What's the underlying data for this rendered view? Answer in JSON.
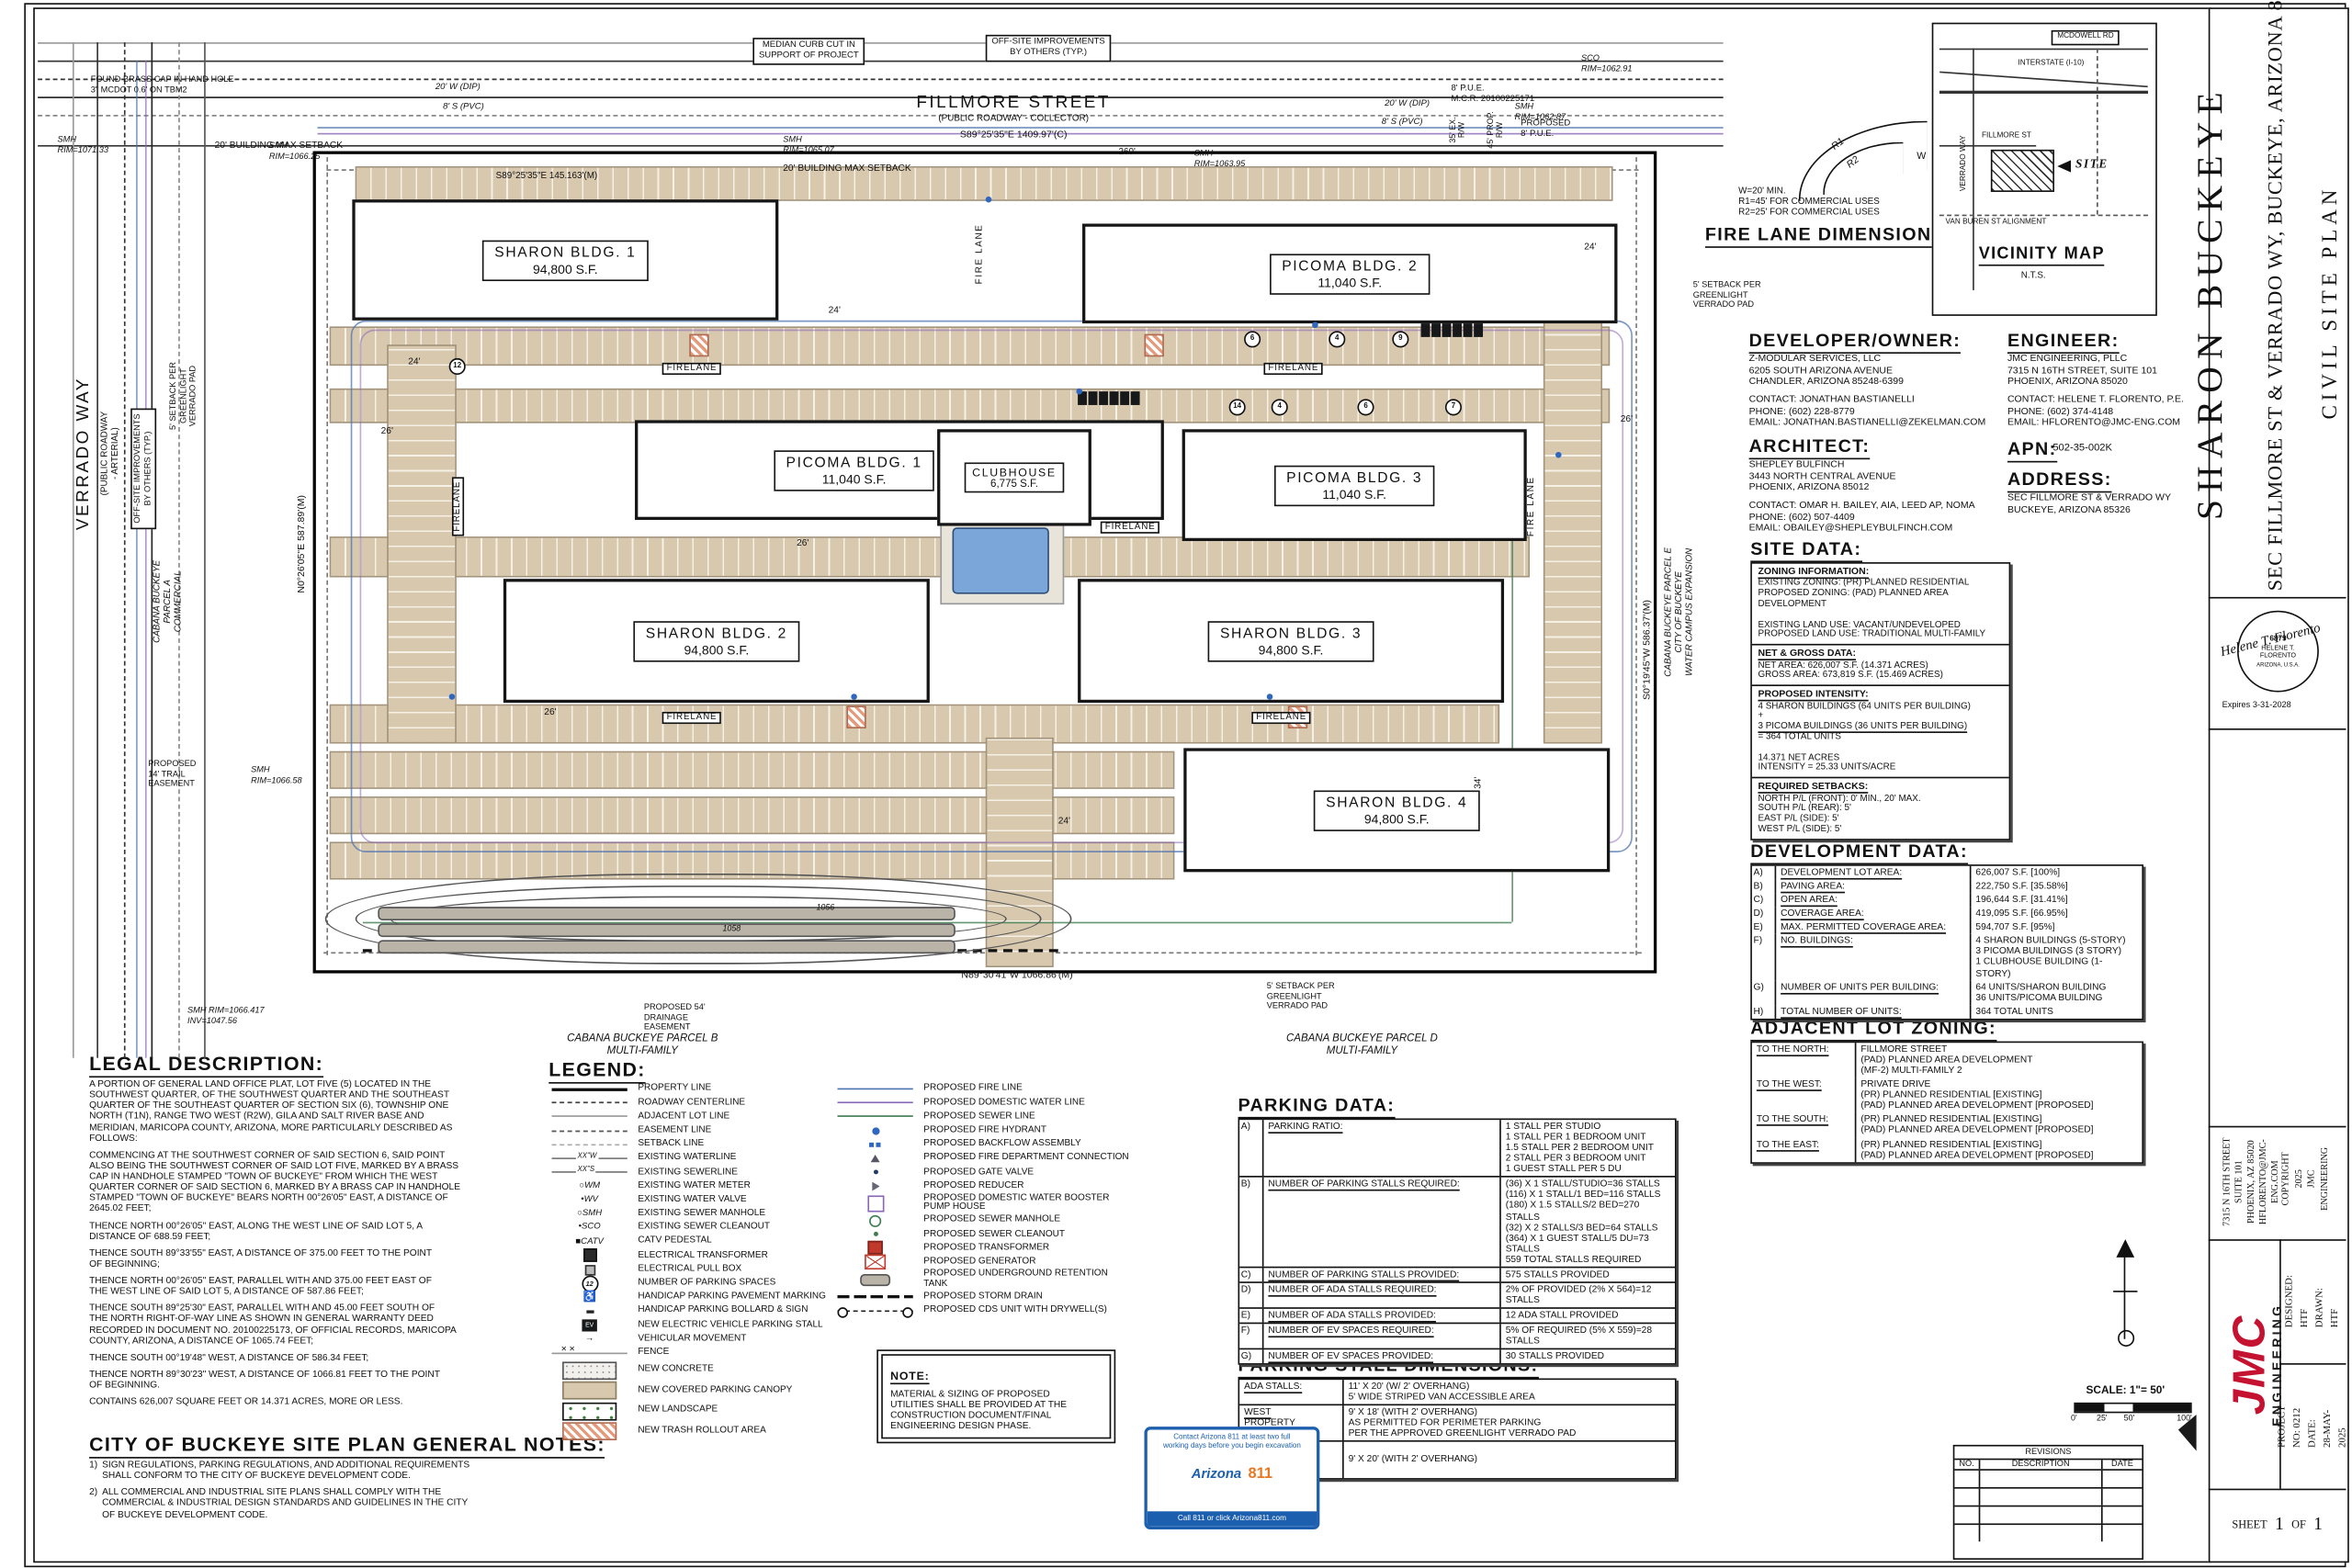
{
  "title_block": {
    "project_title": "SHARON BUCKEYE",
    "project_subtitle": "SEC FILLMORE ST & VERRADO WY, BUCKEYE, ARIZONA 85326",
    "sheet_name": "CIVIL SITE PLAN",
    "seal": {
      "number": "6879",
      "name1": "HELENE T.",
      "name2": "FLORENTO",
      "state": "ARIZONA, U.S.A.",
      "signature": "Helene T. Florento",
      "expires": "Expires 3-31-2028"
    },
    "firm_address": "7315 N 16TH STREET\nSUITE 101\nPHOENIX, AZ 85020\nHFLORENTO@JMC-ENG.COM",
    "copyright": "COPYRIGHT 2025\nJMC ENGINEERING",
    "logo_jmc": "JMC",
    "logo_engineering": "ENGINEERING",
    "designed": "DESIGNED:   HTF\nDRAWN:       HTF",
    "project": "PROJECT NO: 0212\nDATE:  28-MAY-2025",
    "sheet_label": "SHEET",
    "sheet_no": "1",
    "of_label": "OF",
    "sheet_total": "1"
  },
  "revisions": {
    "title": "REVISIONS",
    "col_no": "NO.",
    "col_desc": "DESCRIPTION",
    "col_date": "DATE"
  },
  "scale": {
    "label": "SCALE: 1\"= 50'",
    "t0": "0'",
    "t1": "25'",
    "t2": "50'",
    "t3": "100'"
  },
  "az811": {
    "top": "Contact Arizona 811 at least two full\nworking days before you begin excavation",
    "brand_a": "Arizona",
    "brand_b": "811",
    "bottom": "Call 811 or click Arizona811.com"
  },
  "vicinity": {
    "mcdowell": "MCDOWELL RD",
    "i10": "INTERSTATE (I-10)",
    "verrado": "VERRADO WAY",
    "fillmore": "FILLMORE ST",
    "site": "SITE",
    "vanburen": "VAN BUREN ST ALIGNMENT",
    "title": "VICINITY MAP",
    "nts": "N.T.S."
  },
  "fire_lane": {
    "heading": "FIRE LANE DIMENSIONS",
    "notes": "W=20' MIN.\nR1=45' FOR COMMERCIAL USES\nR2=25' FOR COMMERCIAL USES",
    "r1": "R1",
    "r2": "R2",
    "w": "W"
  },
  "contacts": {
    "developer": {
      "heading": "DEVELOPER/OWNER:",
      "addr": "Z-MODULAR SERVICES, LLC\n6205 SOUTH ARIZONA AVENUE\nCHANDLER, ARIZONA 85248-6399",
      "contact": "CONTACT: JONATHAN BASTIANELLI\nPHONE: (602) 228-8779\nEMAIL: JONATHAN.BASTIANELLI@ZEKELMAN.COM"
    },
    "architect": {
      "heading": "ARCHITECT:",
      "addr": "SHEPLEY BULFINCH\n3443 NORTH CENTRAL AVENUE\nPHOENIX, ARIZONA 85012",
      "contact": "CONTACT: OMAR H. BAILEY, AIA, LEED AP, NOMA\nPHONE: (602) 507-4409\nEMAIL: OBAILEY@SHEPLEYBULFINCH.COM"
    },
    "engineer": {
      "heading": "ENGINEER:",
      "addr": "JMC ENGINEERING, PLLC\n7315 N 16TH STREET, SUITE 101\nPHOENIX, ARIZONA 85020",
      "contact": "CONTACT: HELENE T. FLORENTO, P.E.\nPHONE: (602) 374-4148\nEMAIL: HFLORENTO@JMC-ENG.COM"
    },
    "apn_label": "APN:",
    "apn_value": "502-35-002K",
    "address_heading": "ADDRESS:",
    "address_lines": "SEC FILLMORE ST & VERRADO WY\nBUCKEYE, ARIZONA 85326"
  },
  "site_data": {
    "heading": "SITE DATA:",
    "zoning_h": "ZONING INFORMATION:",
    "zoning": "EXISTING ZONING: (PR) PLANNED RESIDENTIAL\nPROPOSED ZONING: (PAD) PLANNED AREA DEVELOPMENT\n\nEXISTING LAND USE: VACANT/UNDEVELOPED\nPROPOSED LAND USE: TRADITIONAL MULTI-FAMILY",
    "net_h": "NET & GROSS DATA:",
    "net": "NET AREA: 626,007 S.F. (14.371 ACRES)\nGROSS AREA: 673,819 S.F. (15.469 ACRES)",
    "intensity_h": "PROPOSED INTENSITY:",
    "intensity1": "4 SHARON BUILDINGS (64 UNITS PER BUILDING)\n+",
    "intensity2": "3 PICOMA BUILDINGS (36 UNITS PER BUILDING)",
    "intensity3": "= 364 TOTAL UNITS\n\n14.371 NET ACRES\nINTENSITY = 25.33 UNITS/ACRE",
    "setbacks_h": "REQUIRED SETBACKS:",
    "setbacks": "NORTH P/L (FRONT):  0' MIN., 20' MAX.\nSOUTH P/L (REAR):   5'\nEAST P/L (SIDE):      5'\nWEST P/L (SIDE):     5'"
  },
  "development_data": {
    "heading": "DEVELOPMENT DATA:",
    "rows": [
      {
        "k": "A)",
        "label": "DEVELOPMENT LOT AREA:",
        "value": "626,007 S.F. [100%]"
      },
      {
        "k": "B)",
        "label": "PAVING AREA:",
        "value": "222,750  S.F. [35.58%]"
      },
      {
        "k": "C)",
        "label": "OPEN AREA:",
        "value": "196,644 S.F. [31.41%]"
      },
      {
        "k": "D)",
        "label": "COVERAGE AREA:",
        "value": "419,095 S.F. [66.95%]"
      },
      {
        "k": "E)",
        "label": "MAX. PERMITTED COVERAGE AREA:",
        "value": "594,707 S.F. [95%]"
      },
      {
        "k": "F)",
        "label": "NO. BUILDINGS:",
        "value": "4 SHARON BUILDINGS (5-STORY)\n3 PICOMA BUILDINGS (3 STORY)\n1 CLUBHOUSE BUILDING (1-STORY)"
      },
      {
        "k": "G)",
        "label": "NUMBER OF UNITS PER BUILDING:",
        "value": "64 UNITS/SHARON BUILDING\n36 UNITS/PICOMA BUILDING"
      },
      {
        "k": "H)",
        "label": "TOTAL NUMBER OF UNITS:",
        "value": "364 TOTAL UNITS"
      }
    ]
  },
  "adjacent_zoning": {
    "heading": "ADJACENT LOT ZONING:",
    "rows": [
      {
        "label": "TO THE NORTH:",
        "value": "FILLMORE STREET\n(PAD) PLANNED AREA DEVELOPMENT\n(MF-2) MULTI-FAMILY 2"
      },
      {
        "label": "TO THE WEST:",
        "value": "PRIVATE DRIVE\n(PR) PLANNED RESIDENTIAL [EXISTING]\n(PAD) PLANNED AREA DEVELOPMENT [PROPOSED]"
      },
      {
        "label": "TO THE SOUTH:",
        "value": "(PR) PLANNED RESIDENTIAL [EXISTING]\n(PAD) PLANNED AREA DEVELOPMENT [PROPOSED]"
      },
      {
        "label": "TO THE EAST:",
        "value": "(PR) PLANNED RESIDENTIAL [EXISTING]\n(PAD) PLANNED AREA DEVELOPMENT [PROPOSED]"
      }
    ]
  },
  "parking_data": {
    "heading": "PARKING DATA:",
    "rows": [
      {
        "k": "A)",
        "label": "PARKING RATIO:",
        "value": "1 STALL PER STUDIO\n1 STALL PER 1 BEDROOM UNIT\n1.5 STALL PER 2 BEDROOM UNIT\n2 STALL PER 3 BEDROOM UNIT\n1 GUEST STALL PER 5 DU"
      },
      {
        "k": "B)",
        "label": "NUMBER OF PARKING STALLS REQUIRED:",
        "value": "(36) X 1 STALL/STUDIO=36 STALLS\n(116) X 1 STALL/1 BED=116 STALLS\n(180) X 1.5 STALLS/2 BED=270 STALLS\n(32) X 2 STALLS/3 BED=64 STALLS\n(364) X 1 GUEST STALL/5 DU=73 STALLS\n559 TOTAL STALLS REQUIRED"
      },
      {
        "k": "C)",
        "label": "NUMBER OF PARKING STALLS PROVIDED:",
        "value": "575 STALLS PROVIDED"
      },
      {
        "k": "D)",
        "label": "NUMBER OF ADA STALLS REQUIRED:",
        "value": "2% OF PROVIDED (2% X 564)=12 STALLS"
      },
      {
        "k": "E)",
        "label": "NUMBER OF ADA STALLS PROVIDED:",
        "value": "12 ADA STALL PROVIDED"
      },
      {
        "k": "F)",
        "label": "NUMBER OF EV SPACES REQUIRED:",
        "value": "5% OF REQUIRED (5% X 559)=28 STALLS"
      },
      {
        "k": "G)",
        "label": "NUMBER OF EV SPACES PROVIDED:",
        "value": "30 STALLS PROVIDED"
      }
    ]
  },
  "stall_dims": {
    "heading": "PARKING STALL DIMENSIONS:",
    "rows": [
      {
        "label": "ADA STALLS:",
        "value": "11' X 20' (W/ 2' OVERHANG)\n5' WIDE STRIPED VAN ACCESSIBLE AREA"
      },
      {
        "label": "WEST\nPROPERTY\nBOUNDARY:",
        "value": "9' X 18' (WITH 2' OVERHANG)\nAS PERMITTED FOR PERIMETER PARKING\nPER THE APPROVED GREENLIGHT VERRADO PAD"
      },
      {
        "label": "STANDARD\nPARKING\nREST OF SITE:",
        "value": "9' X 20' (WITH 2' OVERHANG)"
      }
    ]
  },
  "legal": {
    "heading": "LEGAL DESCRIPTION:",
    "paragraphs": [
      "A PORTION OF GENERAL LAND OFFICE PLAT, LOT FIVE (5) LOCATED IN THE\nSOUTHWEST QUARTER, OF THE SOUTHWEST QUARTER AND THE SOUTHEAST\nQUARTER OF THE SOUTHEAST QUARTER OF SECTION SIX (6), TOWNSHIP ONE\nNORTH (T1N), RANGE TWO WEST (R2W), GILA AND SALT RIVER BASE AND\nMERIDIAN, MARICOPA COUNTY, ARIZONA, MORE PARTICULARLY DESCRIBED AS\nFOLLOWS:",
      "COMMENCING AT THE SOUTHWEST CORNER OF SAID SECTION 6, SAID POINT\nALSO BEING THE SOUTHWEST CORNER OF SAID LOT FIVE, MARKED BY A BRASS\nCAP IN HANDHOLE STAMPED \"TOWN OF BUCKEYE\" FROM WHICH THE WEST\nQUARTER CORNER OF SAID SECTION 6, MARKED BY A BRASS CAP IN HANDHOLE\nSTAMPED \"TOWN OF BUCKEYE\" BEARS  NORTH 00°26'05\" EAST, A DISTANCE OF\n2645.02 FEET;",
      "THENCE NORTH 00°26'05\" EAST, ALONG THE WEST LINE OF SAID LOT 5, A\nDISTANCE OF 688.59 FEET;",
      "THENCE SOUTH 89°33'55\" EAST, A DISTANCE OF 375.00 FEET TO THE POINT\nOF BEGINNING;",
      "THENCE NORTH 00°26'05\" EAST, PARALLEL WITH AND 375.00 FEET EAST OF\nTHE WEST LINE OF SAID LOT 5, A DISTANCE OF 587.86 FEET;",
      "THENCE SOUTH 89°25'30\" EAST, PARALLEL WITH AND 45.00 FEET SOUTH OF\nTHE NORTH RIGHT-OF-WAY LINE AS SHOWN IN GENERAL WARRANTY DEED\nRECORDED IN DOCUMENT NO. 20100225173, OF OFFICIAL RECORDS, MARICOPA\nCOUNTY, ARIZONA, A DISTANCE OF 1065.74 FEET;",
      "THENCE SOUTH 00°19'48\" WEST, A DISTANCE OF 586.34 FEET;",
      "THENCE NORTH 89°30'23\" WEST, A DISTANCE OF 1066.81 FEET TO THE POINT\nOF BEGINNING.",
      "CONTAINS 626,007 SQUARE FEET OR 14.371 ACRES, MORE OR LESS."
    ]
  },
  "general_notes": {
    "heading": "CITY OF BUCKEYE SITE PLAN GENERAL NOTES:",
    "notes": [
      {
        "num": "1)",
        "text": "SIGN REGULATIONS, PARKING REGULATIONS, AND ADDITIONAL REQUIREMENTS\nSHALL CONFORM TO THE CITY OF BUCKEYE DEVELOPMENT CODE."
      },
      {
        "num": "2)",
        "text": "ALL COMMERCIAL AND INDUSTRIAL SITE PLANS SHALL COMPLY WITH THE\nCOMMERCIAL & INDUSTRIAL DESIGN STANDARDS AND GUIDELINES IN THE CITY\nOF BUCKEYE DEVELOPMENT CODE."
      }
    ]
  },
  "legend": {
    "heading": "LEGEND:",
    "left": [
      {
        "label": "PROPERTY LINE"
      },
      {
        "label": "ROADWAY CENTERLINE"
      },
      {
        "label": "ADJACENT LOT LINE"
      },
      {
        "label": "EASEMENT LINE"
      },
      {
        "label": "SETBACK LINE"
      },
      {
        "sym": "XX\"W",
        "label": "EXISTING WATERLINE"
      },
      {
        "sym": "XX\"S",
        "label": "EXISTING SEWERLINE"
      },
      {
        "sym": "○WM",
        "label": "EXISTING WATER METER"
      },
      {
        "sym": "•WV",
        "label": "EXISTING WATER VALVE"
      },
      {
        "sym": "○SMH",
        "label": "EXISTING SEWER MANHOLE"
      },
      {
        "sym": "•SCO",
        "label": "EXISTING SEWER CLEANOUT"
      },
      {
        "sym": "■CATV",
        "label": "CATV PEDESTAL"
      },
      {
        "label": "ELECTRICAL TRANSFORMER"
      },
      {
        "label": "ELECTRICAL PULL BOX"
      },
      {
        "sym": "12",
        "label": "NUMBER OF PARKING SPACES"
      },
      {
        "sym": "♿",
        "label": "HANDICAP PARKING PAVEMENT MARKING"
      },
      {
        "label": "HANDICAP PARKING BOLLARD & SIGN"
      },
      {
        "sym": "EV",
        "label": "NEW ELECTRIC VEHICLE PARKING STALL"
      },
      {
        "sym": "→",
        "label": "VEHICULAR MOVEMENT"
      },
      {
        "sym": "✕      ✕",
        "label": "FENCE"
      },
      {
        "label": "NEW CONCRETE"
      },
      {
        "label": "NEW COVERED PARKING CANOPY"
      },
      {
        "label": "NEW LANDSCAPE"
      },
      {
        "label": "NEW TRASH ROLLOUT AREA"
      }
    ],
    "right": [
      {
        "label": "PROPOSED FIRE LINE"
      },
      {
        "label": "PROPOSED DOMESTIC WATER LINE"
      },
      {
        "label": "PROPOSED SEWER LINE"
      },
      {
        "label": "PROPOSED FIRE HYDRANT"
      },
      {
        "label": "PROPOSED BACKFLOW ASSEMBLY"
      },
      {
        "label": "PROPOSED FIRE DEPARTMENT CONNECTION"
      },
      {
        "label": "PROPOSED GATE VALVE"
      },
      {
        "label": "PROPOSED REDUCER"
      },
      {
        "label": "PROPOSED DOMESTIC WATER BOOSTER\nPUMP HOUSE"
      },
      {
        "label": "PROPOSED SEWER MANHOLE"
      },
      {
        "label": "PROPOSED SEWER CLEANOUT"
      },
      {
        "label": "PROPOSED TRANSFORMER"
      },
      {
        "label": "PROPOSED GENERATOR"
      },
      {
        "label": "PROPOSED UNDERGROUND RETENTION\nTANK"
      },
      {
        "label": "PROPOSED STORM DRAIN"
      },
      {
        "label": "PROPOSED CDS UNIT WITH DRYWELL(S)"
      }
    ]
  },
  "note_box": {
    "heading": "NOTE:",
    "text": "MATERIAL & SIZING OF PROPOSED\nUTILITIES SHALL BE PROVIDED AT THE\nCONSTRUCTION DOCUMENT/FINAL\nENGINEERING DESIGN PHASE."
  },
  "plan": {
    "firelane": "FIRELANE",
    "firelane2": "FIRE LANE",
    "buildings": [
      {
        "name": "SHARON BLDG. 1",
        "sf": "94,800 S.F."
      },
      {
        "name": "PICOMA BLDG. 2",
        "sf": "11,040 S.F."
      },
      {
        "name": "PICOMA BLDG. 1",
        "sf": "11,040 S.F."
      },
      {
        "name": "CLUBHOUSE",
        "sf": "6,775 S.F."
      },
      {
        "name": "PICOMA BLDG. 3",
        "sf": "11,040 S.F."
      },
      {
        "name": "SHARON BLDG. 2",
        "sf": "94,800 S.F."
      },
      {
        "name": "SHARON BLDG. 3",
        "sf": "94,800 S.F."
      },
      {
        "name": "SHARON BLDG. 4",
        "sf": "94,800 S.F."
      }
    ],
    "labels": [
      {
        "t": "FOUND BRASS CAP IN HAND HOLE\n3\" MCDOT 0.6' ON TBM2"
      },
      {
        "t": "MEDIAN CURB CUT IN\nSUPPORT OF PROJECT"
      },
      {
        "t": "OFF-SITE IMPROVEMENTS\nBY OTHERS (TYP.)"
      },
      {
        "t": "FILLMORE STREET"
      },
      {
        "t": "(PUBLIC ROADWAY - COLLECTOR)"
      },
      {
        "t": "S89°25'35\"E  1409.97'(C)"
      },
      {
        "t": "260'"
      },
      {
        "t": "20' BUILDING MAX SETBACK"
      },
      {
        "t": "20' BUILDING MAX SETBACK"
      },
      {
        "t": "8' P.U.E.\nM.C.R. 20100225171"
      },
      {
        "t": "PROPOSED\n8' P.U.E."
      },
      {
        "t": "SCO\nRIM=1062.91"
      },
      {
        "t": "SMH\nRIM=1062.87"
      },
      {
        "t": "SMH\nRIM=1071.33"
      },
      {
        "t": "SMH\nRIM=1066.25"
      },
      {
        "t": "SMH\nRIM=1065.07"
      },
      {
        "t": "SMH\nRIM=1063.95"
      },
      {
        "t": "20' W (DIP)"
      },
      {
        "t": "8' S (PVC)"
      },
      {
        "t": "20' W (DIP)"
      },
      {
        "t": "8' S (PVC)"
      },
      {
        "t": "35' EX.\nR/W"
      },
      {
        "t": "45' PROP.\nR/W"
      },
      {
        "t": "S89°25'35\"E 145.163'(M)"
      },
      {
        "t": "VERRADO WAY"
      },
      {
        "t": "(PUBLIC ROADWAY\n- ARTERIAL)"
      },
      {
        "t": "OFF-SITE IMPROVEMENTS\nBY OTHERS (TYP.)"
      },
      {
        "t": "5' SETBACK PER\nGREENLIGHT\nVERRADO PAD"
      },
      {
        "t": "CABANA BUCKEYE\nPARCEL A\nCOMMERCIAL"
      },
      {
        "t": "N0°26'05\"E 587.89'(M)"
      },
      {
        "t": "PROPOSED\n14' TRAIL\nEASEMENT"
      },
      {
        "t": "SMH\nRIM=1066.58"
      },
      {
        "t": "SMH RIM=1066.417\nINV=1047.56"
      },
      {
        "t": "PROPOSED 54'\nDRAINAGE\nEASEMENT"
      },
      {
        "t": "CABANA BUCKEYE PARCEL B\nMULTI-FAMILY"
      },
      {
        "t": "CABANA BUCKEYE PARCEL D\nMULTI-FAMILY"
      },
      {
        "t": "5' SETBACK PER\nGREENLIGHT\nVERRADO PAD"
      },
      {
        "t": "N89°30'41\"W 1066.86'(M)"
      },
      {
        "t": "S0°19'45\"W 586.37'(M)"
      },
      {
        "t": "CABANA BUCKEYE PARCEL E\nCITY OF BUCKEYE\nWATER CAMPUS EXPANSION"
      },
      {
        "t": "5' SETBACK PER\nGREENLIGHT\nVERRADO PAD"
      }
    ],
    "dims": [
      "26'",
      "24'",
      "24'",
      "26'",
      "24'",
      "26'",
      "34'",
      "24'",
      "26'"
    ],
    "contour_labels": [
      "1056",
      "1058"
    ],
    "stall_counts": [
      "6",
      "4",
      "9",
      "14",
      "4",
      "6",
      "7",
      "12"
    ]
  },
  "colors": {
    "parking_tan": "#d8c8ae",
    "pool_blue": "#7aa6d9",
    "fire_blue": "#4f74b0",
    "water_purple": "#8a68b8",
    "sewer_green": "#3f7d4f",
    "logo_red": "#c41230",
    "az811_blue": "#1b5fae",
    "trash_salmon": "#e59a7c"
  }
}
